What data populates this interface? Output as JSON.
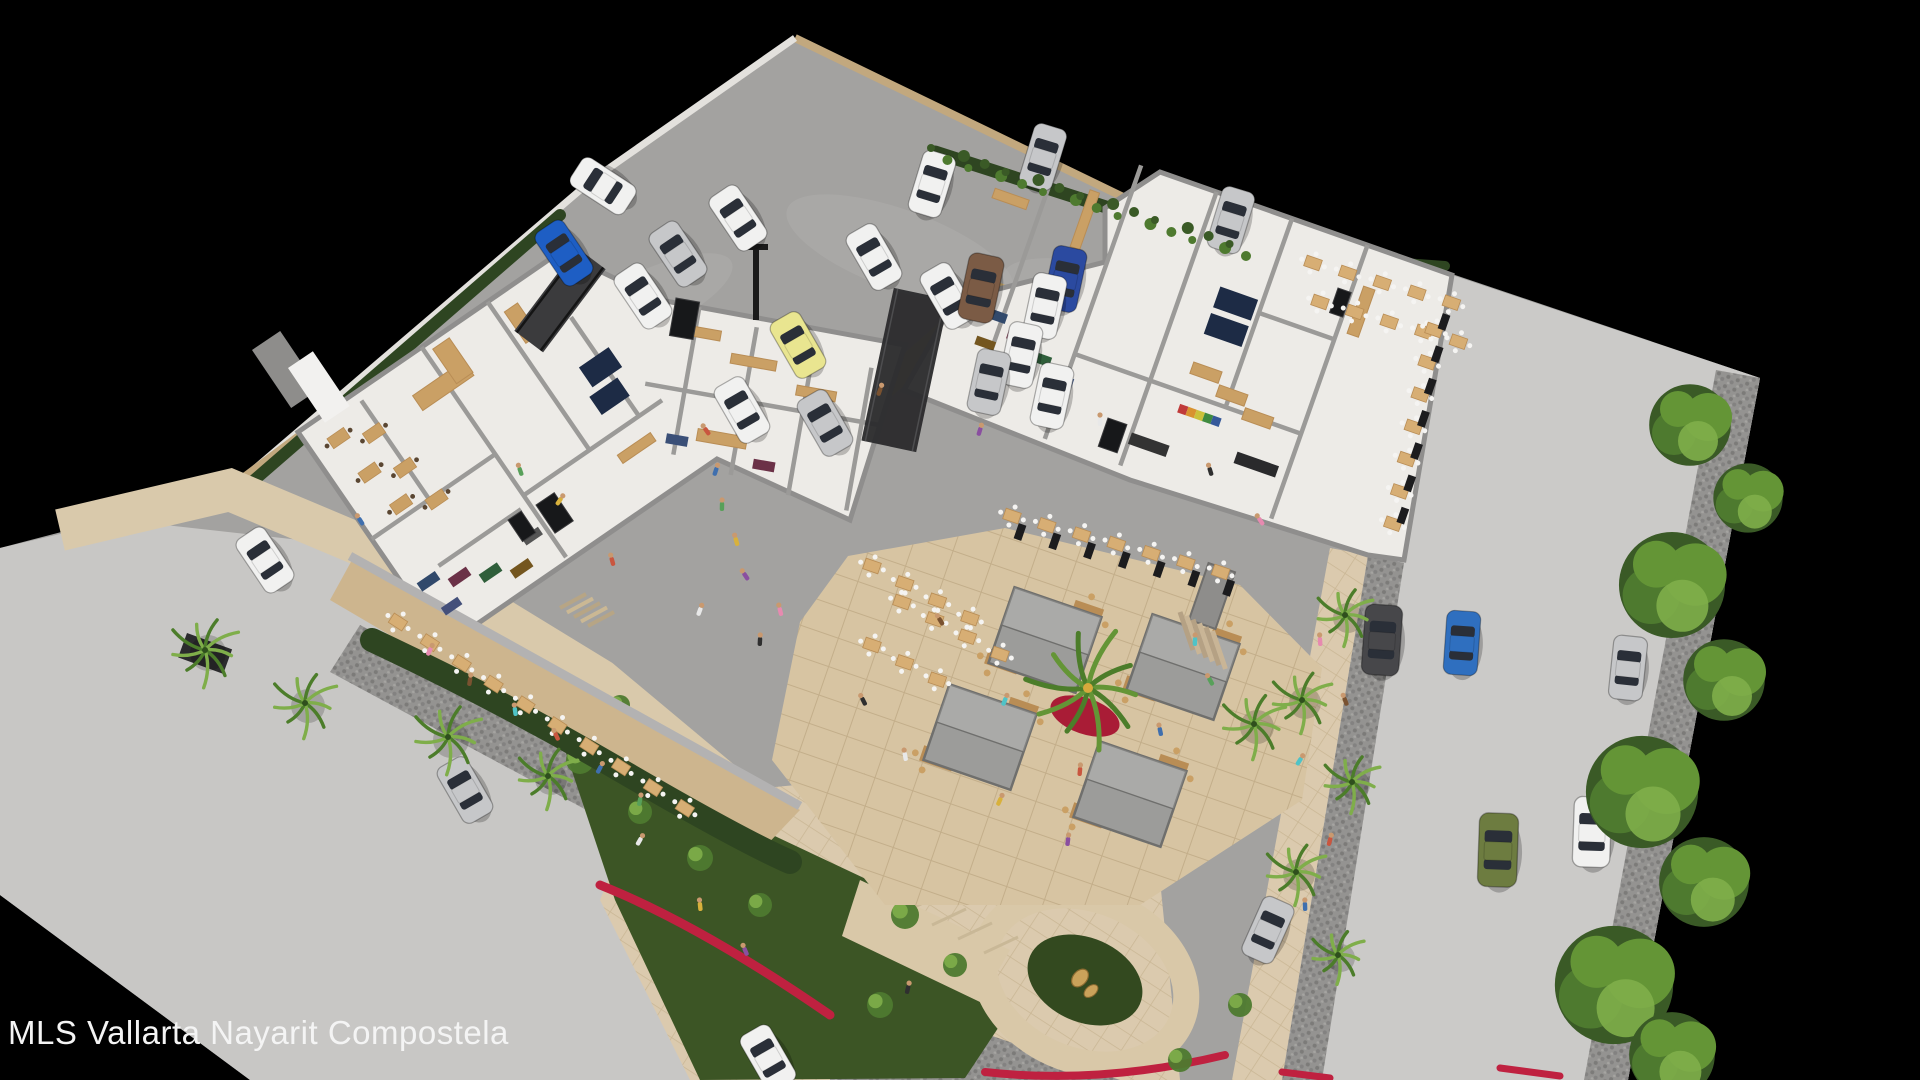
{
  "watermark": "MLS Vallarta Nayarit Compostela",
  "scene_label": "aerial-3d-rendering-of-commercial-plaza",
  "palette": {
    "bg": "#000000",
    "parking": "#a3a2a0",
    "parkingStain": "#aeadab",
    "roadL": "#c8c7c5",
    "street": "#cbcac8",
    "floor": "#edebe7",
    "wall": "#8f8e8d",
    "wallLight": "#e3e1dd",
    "tanWall": "#c2a87e",
    "tanStrip": "#c9a96e",
    "wood": "#caa065",
    "woodDark": "#b98d55",
    "deck": "#cdb58e",
    "navy": "#1d2b45",
    "hedge": "#2e4521",
    "leaf1": "#4e7a2f",
    "leaf2": "#649536",
    "leaf3": "#7fae4a",
    "palm": "#4c7d2a",
    "trunk": "#8a7a5e",
    "beige": "#d8c5a3",
    "beige2": "#dbcaae",
    "grout": "#c3ae8a",
    "cobble": "#8f8e8b",
    "cobbleDot": "#7c7b79",
    "red": "#bf2140",
    "redLight": "#d23752",
    "gold": "#caa25a",
    "kioskRoof": "#9c9c9a",
    "kioskEdge": "#6f6f6d",
    "post": "#1c1c1e",
    "railing": "#b3b2b0",
    "bridge": "#3b3b3d",
    "canopy": "#2c2c2e",
    "stone": "#8e8d8b",
    "text": "#f4f4f4"
  },
  "carColors": {
    "w": "#f1f1f0",
    "s": "#c6c7c9",
    "y": "#e9e590",
    "b": "#1e5ec4",
    "db": "#2b4aa0",
    "br": "#7b5b45",
    "dg": "#47474a",
    "ol": "#6d7c40",
    "t": "#2f6fbf"
  },
  "personColors": [
    "#c9563f",
    "#3f6fae",
    "#58a05a",
    "#d8b13c",
    "#8a4fa0",
    "#e8e8e8",
    "#2f2f2f",
    "#e78ab0",
    "#7a5230",
    "#4fc3c7"
  ],
  "polys": {
    "site": "795,38 1240,250 1455,275 1760,378 1628,1080 250,1080 0,895 0,548 230,488 592,180",
    "leftRoad": "0,548 120,520 300,540 470,600 600,690 680,780 700,900 700,1080 250,1080 0,895",
    "cobbleCrossing": "360,625 770,835 735,890 330,672",
    "cobbleBottom": "830,980 1120,1080 830,1080",
    "plazaBottom": "640,800 900,775 1160,880 1180,1080 690,1080 600,900",
    "gardenBed": "560,735 900,895 1010,1010 965,1078 700,1080 615,900",
    "streetRoad": "1452,275 1760,378 1628,1080 1282,1080 1368,555",
    "cobbleStreetL": "1368,555 1404,563 1322,1080 1282,1080",
    "cobbleStreetR": "1760,378 1628,1080 1584,1080 1716,370",
    "sidewalkR": "1330,548 1368,555 1282,1080 1232,1080",
    "leftWing": "298,432 560,252 660,300 905,345 850,520 717,459 445,646",
    "rightWing": "1105,208 1160,172 1452,275 1404,560 1368,555 1130,480 904,390 955,300 1105,262",
    "terraceDeck": "352,560 800,810 760,852 330,600",
    "courtyard": "848,556 1005,528 1240,585 1322,668 1302,800 1140,905 885,905 772,760 800,622",
    "pathWedge": "860,880 1010,950 980,1002 842,936"
  },
  "paths": {
    "wallTopRight": "M795,38 L1146,208 L1240,250",
    "wallTopLeft": "M795,38 L592,180 L232,488",
    "wallLowerLeft": "M232,488 L312,428",
    "hedgeTR": "M935,152 L1246,252",
    "hedgeNE": "M1252,252 L1445,266",
    "hedgeInnerLeft": "M560,215 L252,482",
    "hedgeSW": "M372,640 Q500,700 620,770 T790,862",
    "sidewalkSW": "M60,530 L230,490 L420,570 L600,680 L770,822",
    "railSW": "M350,556 L800,806",
    "redRibbon1": "M600,885 Q700,925 830,1015",
    "redRibbon2": "M985,1072 Q1100,1085 1225,1055",
    "redRibbon3": "M1282,1072 L1330,1078",
    "redRibbon4": "M1500,1068 L1560,1076"
  },
  "loop": {
    "cx": 1085,
    "cy": 980,
    "rx": 105,
    "ry": 80,
    "rot": 24,
    "innerRx": 60,
    "innerRy": 42
  },
  "sculpture": {
    "x": 1080,
    "y": 978
  },
  "stains": [
    [
      900,
      250,
      120,
      40,
      20
    ],
    [
      650,
      300,
      90,
      30,
      -25
    ],
    [
      1100,
      300,
      100,
      34,
      15
    ],
    [
      500,
      700,
      110,
      36,
      28
    ],
    [
      1500,
      700,
      90,
      40,
      80
    ]
  ],
  "tanStrip": "990,278 1014,289 834,447 810,436",
  "cars": [
    [
      603,
      186,
      -57,
      "w",
      1
    ],
    [
      738,
      218,
      -34,
      "w",
      1
    ],
    [
      678,
      254,
      -34,
      "s",
      1
    ],
    [
      643,
      296,
      -34,
      "w",
      1
    ],
    [
      564,
      253,
      -34,
      "b",
      1
    ],
    [
      932,
      184,
      17,
      "w",
      1
    ],
    [
      1043,
      157,
      17,
      "s",
      1
    ],
    [
      1231,
      220,
      17,
      "s",
      1
    ],
    [
      874,
      257,
      -30,
      "w",
      1
    ],
    [
      948,
      296,
      -30,
      "w",
      1
    ],
    [
      798,
      345,
      -30,
      "y",
      1
    ],
    [
      742,
      410,
      -30,
      "w",
      1
    ],
    [
      825,
      423,
      -30,
      "s",
      1
    ],
    [
      981,
      288,
      12,
      "br",
      1.05
    ],
    [
      1065,
      279,
      12,
      "db",
      1
    ],
    [
      1045,
      306,
      12,
      "w",
      1
    ],
    [
      1021,
      355,
      12,
      "w",
      1
    ],
    [
      989,
      382,
      12,
      "s",
      1
    ],
    [
      1052,
      396,
      12,
      "w",
      1
    ],
    [
      265,
      560,
      -34,
      "w",
      1
    ],
    [
      465,
      790,
      -30,
      "s",
      1
    ],
    [
      768,
      1058,
      -30,
      "w",
      1
    ],
    [
      1382,
      640,
      4,
      "dg",
      1.1
    ],
    [
      1462,
      643,
      4,
      "t",
      1
    ],
    [
      1498,
      850,
      2,
      "ol",
      1.15
    ],
    [
      1592,
      832,
      2,
      "w",
      1.1
    ],
    [
      1268,
      930,
      24,
      "s",
      1
    ],
    [
      1628,
      668,
      6,
      "s",
      1
    ]
  ],
  "kiosks": [
    [
      1045,
      640,
      19
    ],
    [
      1183,
      667,
      19
    ],
    [
      980,
      737,
      19
    ],
    [
      1130,
      794,
      19
    ]
  ],
  "palms": [
    [
      205,
      650,
      36
    ],
    [
      305,
      703,
      34
    ],
    [
      448,
      737,
      36
    ],
    [
      548,
      776,
      32
    ],
    [
      1345,
      615,
      30
    ],
    [
      1302,
      700,
      32
    ],
    [
      1352,
      782,
      30
    ],
    [
      1296,
      872,
      32
    ],
    [
      1338,
      955,
      28
    ],
    [
      1254,
      724,
      34
    ]
  ],
  "centralPalm": {
    "x": 1088,
    "y": 688,
    "r": 60
  },
  "trees": [
    [
      1690,
      425,
      40
    ],
    [
      1748,
      498,
      34
    ],
    [
      1672,
      585,
      52
    ],
    [
      1724,
      680,
      40
    ],
    [
      1642,
      792,
      55
    ],
    [
      1704,
      882,
      44
    ],
    [
      1614,
      985,
      58
    ],
    [
      1672,
      1055,
      42
    ]
  ],
  "shrubs": [
    [
      580,
      760,
      14
    ],
    [
      640,
      812,
      12
    ],
    [
      700,
      858,
      13
    ],
    [
      760,
      905,
      12
    ],
    [
      905,
      915,
      14
    ],
    [
      955,
      965,
      12
    ],
    [
      1005,
      880,
      11
    ],
    [
      880,
      1005,
      13
    ],
    [
      620,
      705,
      10
    ],
    [
      480,
      640,
      10
    ],
    [
      520,
      663,
      9
    ],
    [
      1240,
      1005,
      12
    ],
    [
      1180,
      1060,
      12
    ]
  ],
  "tableRows": [
    {
      "x": 398,
      "y": 622,
      "rowAngle": 33,
      "rot": 33,
      "n": 10,
      "step": 38
    },
    {
      "x": 872,
      "y": 566,
      "rowAngle": 28,
      "rot": 19,
      "n": 4,
      "step": 37
    },
    {
      "x": 902,
      "y": 602,
      "rowAngle": 28,
      "rot": 19,
      "n": 4,
      "step": 37
    },
    {
      "x": 872,
      "y": 645,
      "rowAngle": 28,
      "rot": 19,
      "n": 3,
      "step": 37
    },
    {
      "x": 1012,
      "y": 516,
      "rowAngle": 15,
      "rot": 19,
      "n": 7,
      "step": 36
    },
    {
      "x": 1313,
      "y": 263,
      "rowAngle": 16,
      "rot": 19,
      "n": 5,
      "step": 36
    },
    {
      "x": 1320,
      "y": 302,
      "rowAngle": 16,
      "rot": 19,
      "n": 5,
      "step": 36
    },
    {
      "x": 1434,
      "y": 330,
      "rowAngle": 102,
      "rot": 19,
      "n": 7,
      "step": 33
    }
  ],
  "postRow": {
    "x": 1444,
    "y": 322,
    "rowAngle": 102,
    "n": 7,
    "step": 33,
    "rot": 19
  },
  "postRowS": {
    "x": 1020,
    "y": 532,
    "rowAngle": 15,
    "n": 7,
    "step": 36,
    "rot": 19
  },
  "frames": {
    "L": {
      "origin": [
        298,
        432
      ],
      "angle": -34.5,
      "walls": [
        [
          70,
          10,
          70,
          130
        ],
        [
          150,
          0,
          150,
          255
        ],
        [
          230,
          0,
          230,
          180
        ],
        [
          0,
          130,
          150,
          130
        ],
        [
          150,
          180,
          318,
          180
        ],
        [
          290,
          60,
          290,
          180
        ],
        [
          40,
          190,
          140,
          190
        ]
      ],
      "woods": [
        [
          115,
          35,
          62,
          18
        ],
        [
          158,
          8,
          20,
          42
        ],
        [
          238,
          18,
          16,
          38
        ],
        [
          250,
          200,
          40,
          10
        ]
      ],
      "navies": [
        [
          268,
          106,
          36,
          24
        ],
        [
          260,
          136,
          34,
          22
        ]
      ],
      "racks": [
        [
          12,
          192,
          22,
          10,
          "#31496b"
        ],
        [
          40,
          206,
          22,
          10,
          "#6b3147"
        ],
        [
          68,
          220,
          22,
          10,
          "#2f5e3a"
        ],
        [
          96,
          234,
          22,
          10,
          "#74561f"
        ],
        [
          18,
          226,
          20,
          9,
          "#44507a"
        ],
        [
          124,
          214,
          20,
          9,
          "#555555"
        ]
      ],
      "tables": [
        [
          20,
          22
        ],
        [
          52,
          38
        ],
        [
          26,
          68
        ],
        [
          58,
          84
        ],
        [
          34,
          112
        ],
        [
          66,
          128
        ]
      ]
    },
    "M": {
      "origin": [
        660,
        300
      ],
      "angle": 10,
      "walls": [
        [
          40,
          0,
          40,
          150
        ],
        [
          100,
          10,
          100,
          160
        ],
        [
          160,
          20,
          160,
          170
        ],
        [
          220,
          30,
          220,
          175
        ],
        [
          0,
          85,
          240,
          85
        ]
      ],
      "woods": [
        [
          20,
          20,
          46,
          10
        ],
        [
          80,
          40,
          46,
          10
        ],
        [
          150,
          60,
          40,
          10
        ],
        [
          60,
          120,
          50,
          12
        ]
      ],
      "navies": [],
      "racks": [
        [
          30,
          130,
          22,
          10,
          "#3a4f77"
        ],
        [
          120,
          140,
          22,
          10,
          "#6b3147"
        ]
      ],
      "tables": []
    },
    "R": {
      "origin": [
        1160,
        172
      ],
      "angle": 19.4,
      "walls": [
        [
          -100,
          40,
          -100,
          280
        ],
        [
          -20,
          0,
          -20,
          290
        ],
        [
          60,
          0,
          60,
          290
        ],
        [
          140,
          0,
          140,
          200
        ],
        [
          220,
          0,
          220,
          290
        ],
        [
          -20,
          200,
          220,
          200
        ],
        [
          140,
          100,
          220,
          100
        ]
      ],
      "woods": [
        [
          95,
          168,
          30,
          12
        ],
        [
          127,
          181,
          30,
          12
        ],
        [
          159,
          194,
          30,
          12
        ],
        [
          -150,
          70,
          36,
          10
        ],
        [
          -60,
          40,
          10,
          60
        ],
        [
          230,
          40,
          12,
          50
        ]
      ],
      "navies": [
        [
          95,
          88,
          40,
          22
        ],
        [
          95,
          116,
          40,
          22
        ]
      ],
      "racks": [
        [
          -118,
          185,
          22,
          10,
          "#31496b"
        ],
        [
          -90,
          198,
          22,
          10,
          "#833a55"
        ],
        [
          -62,
          211,
          22,
          10,
          "#2f5e3a"
        ],
        [
          -118,
          215,
          20,
          9,
          "#74561f"
        ],
        [
          -34,
          224,
          22,
          10,
          "#4a5f8a"
        ],
        [
          166,
          238,
          44,
          12,
          "#2a2a2c"
        ],
        [
          60,
          255,
          40,
          12,
          "#333333"
        ]
      ],
      "tables": []
    }
  },
  "rainbowShelf": {
    "frame": "R",
    "x": 96,
    "y": 212,
    "w": 44,
    "h": 9
  },
  "posters": [
    [
      536,
      505,
      22,
      34,
      -34
    ],
    [
      508,
      520,
      16,
      26,
      -34
    ],
    [
      676,
      298,
      24,
      38,
      10
    ],
    [
      1108,
      418,
      20,
      30,
      19
    ],
    [
      1338,
      288,
      14,
      26,
      19
    ]
  ],
  "bridge": {
    "x": 560,
    "y": 300,
    "rot": 37,
    "w": 36,
    "l": 104
  },
  "canopy": {
    "x": 905,
    "y": 370,
    "rot": 12,
    "w": 56,
    "l": 156
  },
  "pole": {
    "x": 756,
    "y": 250,
    "h": 70
  },
  "entry": [
    [
      252,
      350,
      34,
      70,
      -34,
      "#8e8d8b"
    ],
    [
      288,
      368,
      30,
      66,
      -34,
      "#f2f1ef"
    ]
  ],
  "stonePillar": {
    "x": 1212,
    "y": 596,
    "rot": 19
  },
  "stairsCourtyard": {
    "x": 1180,
    "y": 612,
    "n": 6
  },
  "stairsSW": {
    "x": 560,
    "y": 608,
    "n": 5
  },
  "drain": [
    187,
    633,
    48,
    26,
    20
  ],
  "people": [
    [
      706,
      430
    ],
    [
      716,
      470
    ],
    [
      722,
      505
    ],
    [
      736,
      540
    ],
    [
      745,
      575
    ],
    [
      700,
      610
    ],
    [
      760,
      640
    ],
    [
      780,
      610
    ],
    [
      940,
      620
    ],
    [
      1005,
      700
    ],
    [
      1080,
      770
    ],
    [
      1160,
      730
    ],
    [
      1210,
      680
    ],
    [
      1000,
      800
    ],
    [
      1068,
      840
    ],
    [
      905,
      755
    ],
    [
      863,
      700
    ],
    [
      430,
      650
    ],
    [
      470,
      680
    ],
    [
      515,
      710
    ],
    [
      556,
      735
    ],
    [
      600,
      768
    ],
    [
      640,
      800
    ],
    [
      700,
      905
    ],
    [
      745,
      950
    ],
    [
      640,
      840
    ],
    [
      908,
      988
    ],
    [
      1320,
      640
    ],
    [
      1345,
      700
    ],
    [
      1300,
      760
    ],
    [
      1330,
      840
    ],
    [
      1305,
      905
    ],
    [
      520,
      470
    ],
    [
      560,
      500
    ],
    [
      980,
      430
    ],
    [
      1100,
      420
    ],
    [
      1210,
      470
    ],
    [
      1260,
      520
    ],
    [
      880,
      390
    ],
    [
      1195,
      640
    ],
    [
      612,
      560
    ],
    [
      360,
      520
    ]
  ]
}
